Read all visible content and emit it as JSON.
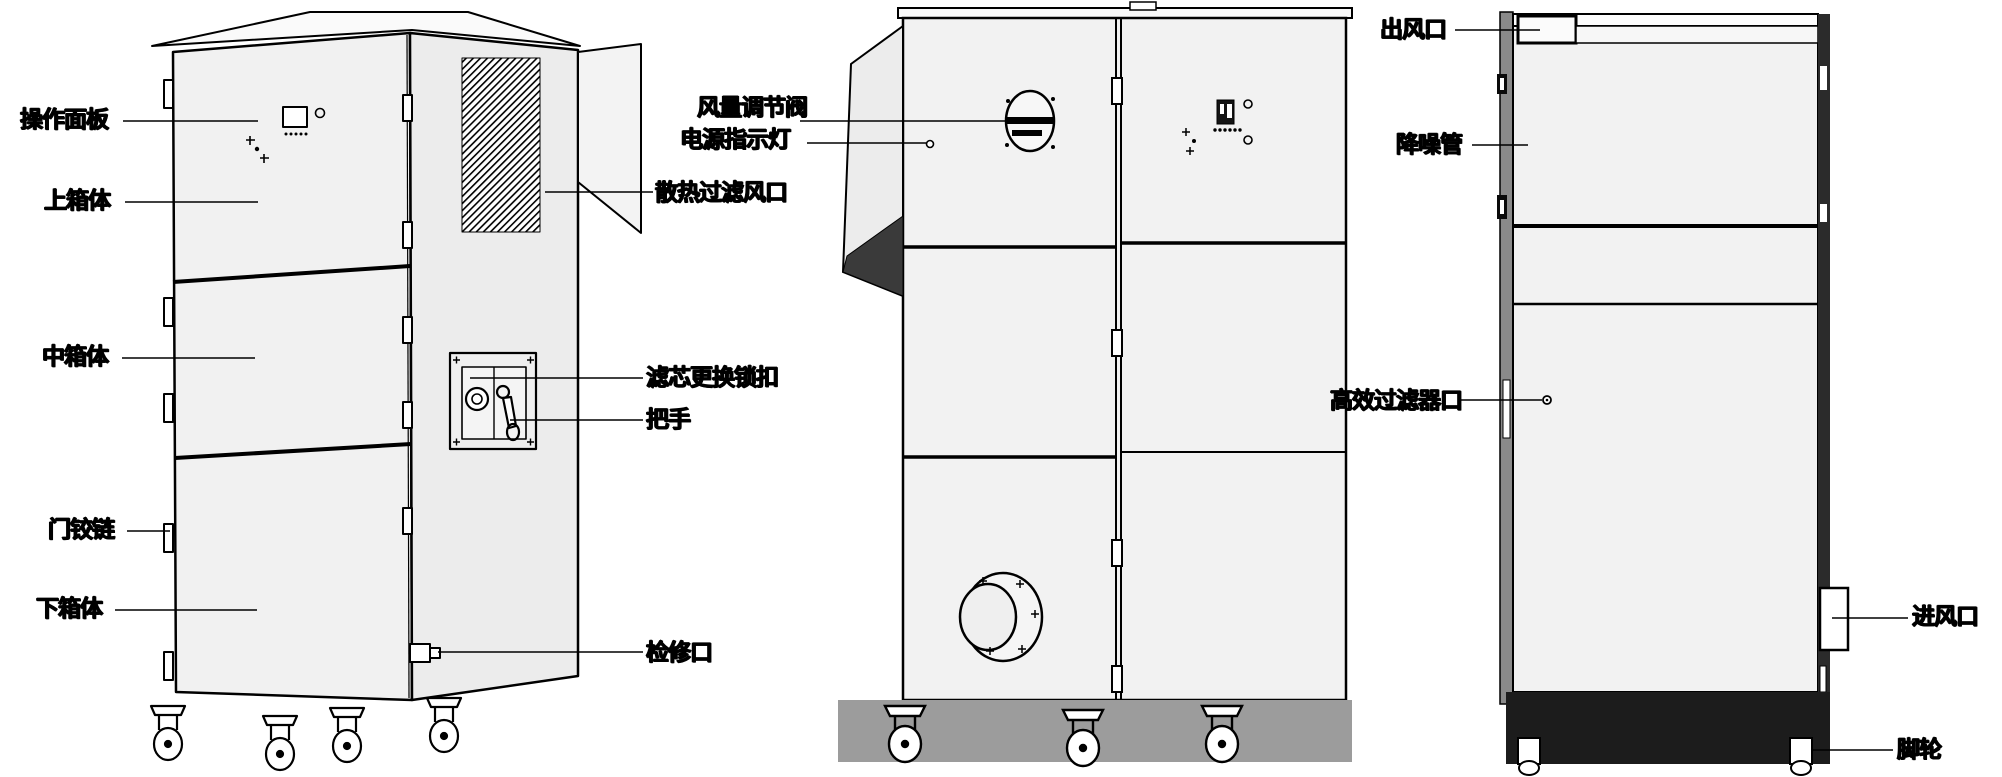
{
  "figure": {
    "kind": "equipment-annotation-diagram",
    "views_count": 3
  },
  "colors": {
    "background": "#ffffff",
    "line": "#000000",
    "panel_fill": "#f1f1f1",
    "side_fill": "#ececec",
    "shadow_band": "#9c9c9c",
    "dark_base": "#1c1c1c",
    "duct_strip": "#8a8a8a",
    "duct_shadow": "#3a3a3a"
  },
  "labels": {
    "operation_panel": "操作面板",
    "upper_cabinet": "上箱体",
    "middle_cabinet": "中箱体",
    "door_hinge": "门铰链",
    "lower_cabinet": "下箱体",
    "air_volume_valve": "风量调节阀",
    "power_indicator": "电源指示灯",
    "cooling_filter_vent": "散热过滤风口",
    "filter_change_lock": "滤芯更换锁扣",
    "handle": "把手",
    "service_port": "检修口",
    "air_outlet": "出风口",
    "noise_reduction_duct": "降噪管",
    "hepa_filter_port": "高效过滤器口",
    "air_inlet": "进风口",
    "casters": "脚轮"
  }
}
